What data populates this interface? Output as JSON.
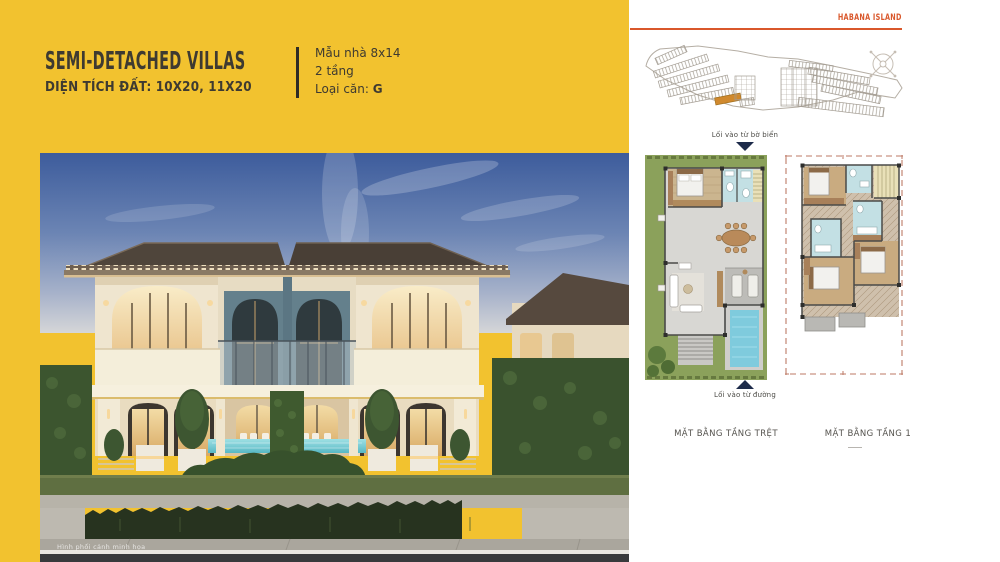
{
  "colors": {
    "yellow": "#F2C22F",
    "orange": "#D9572B",
    "navy": "#1D2B4A",
    "plan_green": "#8BA15B",
    "pool_blue": "#7FCBDD",
    "title_dark": "#3E3A31",
    "lot_highlight": "#D0892E"
  },
  "left_panel": {
    "title": "SEMI-DETACHED VILLAS",
    "subtitle": "DIỆN TÍCH ĐẤT: 10X20, 11X20",
    "spec": {
      "model": "Mẫu nhà 8x14",
      "floors": "2 tầng",
      "unit_label": "Loại căn:",
      "unit_value": "G"
    }
  },
  "photo": {
    "caption": "Hình phối cảnh minh họa"
  },
  "right_panel": {
    "brand": "HABANA ISLAND",
    "beach_entry": "Lối vào từ bờ biển",
    "road_entry": "Lối vào từ đường",
    "plans": [
      {
        "label": "MẶT BẰNG TẦNG TRỆT"
      },
      {
        "label": "MẶT BẰNG TẦNG 1"
      }
    ]
  }
}
